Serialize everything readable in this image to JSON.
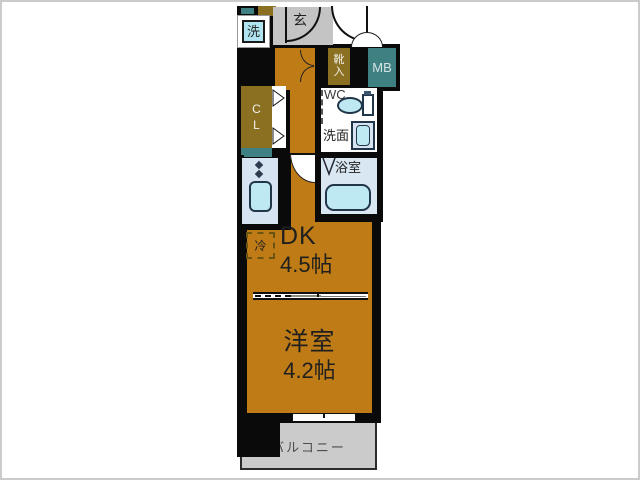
{
  "plan": {
    "fixtures": {
      "washer_label": "洗",
      "entrance_label": "玄",
      "shoe_top": "靴",
      "shoe_bottom": "入",
      "meter_label": "MB",
      "closet_top": "C",
      "closet_bottom": "L",
      "wc_label": "WC",
      "washstand_label": "洗面",
      "bath_label": "浴室",
      "fridge_label": "冷"
    },
    "rooms": {
      "dk": {
        "name": "DK",
        "size": "4.5帖"
      },
      "western": {
        "name": "洋室",
        "size": "4.2帖"
      },
      "balcony": {
        "name": "バルコニー"
      }
    },
    "colors": {
      "floor": "#bf7b15",
      "wall": "#0a0a0a",
      "storage": "#8a7020",
      "meter": "#3f8182",
      "entrance_gray": "#c4c4c4",
      "balcony_gray": "#cbcbcb",
      "wet_room": "#d9e7f2",
      "fixture_blue": "#bfe9f2",
      "kitchen_panel": "#d6e4f2",
      "washer_blue": "#b0e4f0"
    }
  }
}
